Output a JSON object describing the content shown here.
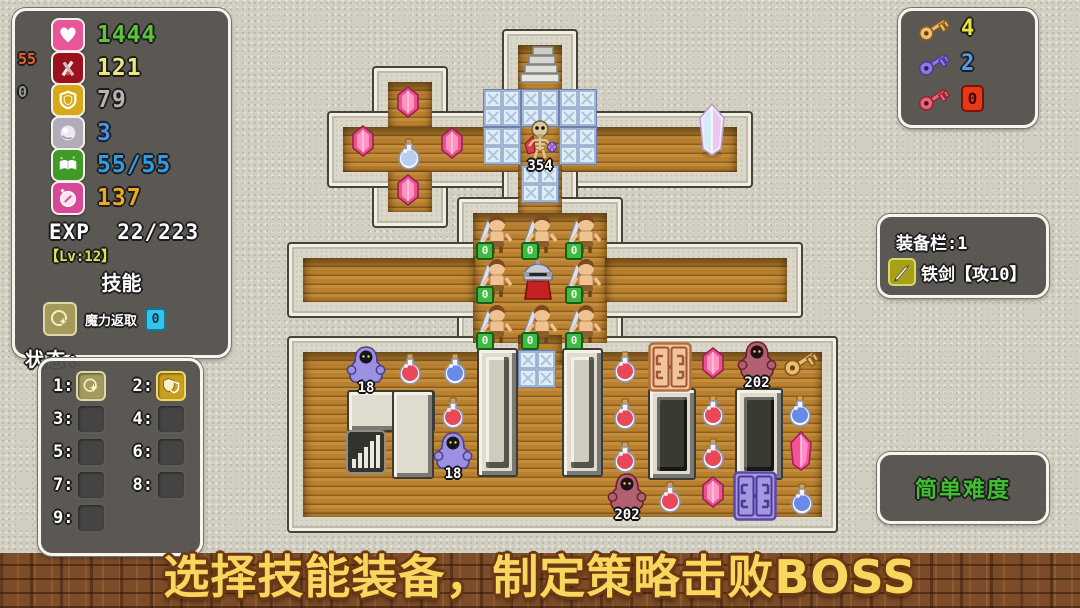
{
  "hud": {
    "stats": {
      "rows": [
        {
          "icon": "heart-icon",
          "value": "1444",
          "color": "#5dc438",
          "icon_bg": "#e8559a"
        },
        {
          "icon": "sword-icon",
          "value": "121",
          "color": "#ece87e",
          "icon_bg": "#9a1220"
        },
        {
          "icon": "shield-icon",
          "value": "79",
          "color": "#b4b4b4",
          "icon_bg": "#d8a818"
        },
        {
          "icon": "orb-icon",
          "value": "3",
          "color": "#4f8fe8",
          "icon_bg": "#b2acba"
        },
        {
          "icon": "book-icon",
          "value": "55/55",
          "color": "#2e9de8",
          "icon_bg": "#3f9a28"
        },
        {
          "icon": "coin-icon",
          "value": "137",
          "color": "#f0a81f",
          "icon_bg": "#d84898"
        }
      ],
      "side_labels": [
        {
          "text": "55",
          "color": "#e8622a",
          "y": 42
        },
        {
          "text": "0",
          "color": "#9a9a9a",
          "y": 76
        }
      ],
      "exp_label": "EXP",
      "exp_value": "22/223",
      "level": "【Lv:12】",
      "skill_header": "技能",
      "skill_name": "魔力返取",
      "skill_count": "0",
      "status_label": "状态:"
    },
    "skill_slots": {
      "slots": [
        {
          "num": "1:",
          "icon": "magic"
        },
        {
          "num": "2:",
          "icon": "guard"
        },
        {
          "num": "3:",
          "icon": ""
        },
        {
          "num": "4:",
          "icon": ""
        },
        {
          "num": "5:",
          "icon": ""
        },
        {
          "num": "6:",
          "icon": ""
        },
        {
          "num": "7:",
          "icon": ""
        },
        {
          "num": "8:",
          "icon": ""
        },
        {
          "num": "9:",
          "icon": ""
        }
      ]
    },
    "keys": [
      {
        "name": "yellow-key",
        "count": "4",
        "count_color": "#ece43e",
        "fill": "#e8c070",
        "stroke": "#8a5a20"
      },
      {
        "name": "blue-key",
        "count": "2",
        "count_color": "#4f9fe8",
        "fill": "#8a7ae0",
        "stroke": "#4a3a9a"
      },
      {
        "name": "red-key",
        "count": "0",
        "count_color": "#3c0800",
        "fill": "#e06a78",
        "stroke": "#9a2030"
      }
    ],
    "equipment": {
      "title": "装备栏:1",
      "item": "铁剑【攻10】"
    },
    "difficulty": {
      "label": "简单难度",
      "color": "#3fc02e"
    }
  },
  "banner": {
    "text": "选择技能装备，制定策略击败BOSS"
  },
  "colors": {
    "floor_wood": "#b9812f",
    "wall_stone": "#dbd8ca",
    "panel_bg": "#53514d",
    "banner_text": "#f8d75e"
  },
  "map": {
    "floors": [
      {
        "name": "cross-room-vertical",
        "x": 388,
        "y": 82,
        "w": 44,
        "h": 130
      },
      {
        "name": "top-corridor",
        "x": 343,
        "y": 127,
        "w": 394,
        "h": 45
      },
      {
        "name": "stairs-column",
        "x": 518,
        "y": 45,
        "w": 44,
        "h": 170
      },
      {
        "name": "soldier-room",
        "x": 473,
        "y": 213,
        "w": 134,
        "h": 130
      },
      {
        "name": "left-corridor",
        "x": 303,
        "y": 258,
        "w": 172,
        "h": 44
      },
      {
        "name": "right-corridor",
        "x": 605,
        "y": 258,
        "w": 182,
        "h": 44
      },
      {
        "name": "bottom-room",
        "x": 303,
        "y": 352,
        "w": 519,
        "h": 165
      },
      {
        "name": "room-connector",
        "x": 518,
        "y": 335,
        "w": 44,
        "h": 30,
        "wall": false
      }
    ],
    "pillars": [
      {
        "x": 347,
        "y": 390,
        "w": 84,
        "h": 38
      },
      {
        "x": 392,
        "y": 390,
        "w": 38,
        "h": 85
      },
      {
        "x": 477,
        "y": 348,
        "w": 37,
        "h": 125,
        "inner": "light"
      },
      {
        "x": 562,
        "y": 348,
        "w": 37,
        "h": 125,
        "inner": "light"
      },
      {
        "x": 648,
        "y": 388,
        "w": 44,
        "h": 88,
        "inner": "dark"
      },
      {
        "x": 735,
        "y": 388,
        "w": 44,
        "h": 88,
        "inner": "dark"
      }
    ],
    "ice_tiles": [
      {
        "x": 483,
        "y": 89
      },
      {
        "x": 521,
        "y": 89
      },
      {
        "x": 559,
        "y": 89
      },
      {
        "x": 483,
        "y": 127
      },
      {
        "x": 559,
        "y": 127
      },
      {
        "x": 521,
        "y": 165
      },
      {
        "x": 518,
        "y": 350
      }
    ],
    "entities": [
      {
        "t": "stairs-up",
        "x": 540,
        "y": 64
      },
      {
        "t": "gem",
        "x": 408,
        "y": 102
      },
      {
        "t": "gem",
        "x": 363,
        "y": 141
      },
      {
        "t": "gem",
        "x": 452,
        "y": 143
      },
      {
        "t": "gem",
        "x": 408,
        "y": 190
      },
      {
        "t": "potion-white",
        "x": 409,
        "y": 155
      },
      {
        "t": "skeleton",
        "x": 540,
        "y": 142,
        "label": "354"
      },
      {
        "t": "crystal-rainbow",
        "x": 712,
        "y": 131
      },
      {
        "t": "soldier",
        "x": 493,
        "y": 235,
        "badge": "0"
      },
      {
        "t": "soldier",
        "x": 538,
        "y": 235,
        "badge": "0"
      },
      {
        "t": "soldier",
        "x": 582,
        "y": 235,
        "badge": "0"
      },
      {
        "t": "soldier",
        "x": 493,
        "y": 279,
        "badge": "0"
      },
      {
        "t": "soldier",
        "x": 582,
        "y": 279,
        "badge": "0"
      },
      {
        "t": "soldier",
        "x": 493,
        "y": 325,
        "badge": "0"
      },
      {
        "t": "soldier",
        "x": 538,
        "y": 325,
        "badge": "0"
      },
      {
        "t": "soldier",
        "x": 582,
        "y": 325,
        "badge": "0"
      },
      {
        "t": "knight",
        "x": 538,
        "y": 279
      },
      {
        "t": "ghost-purple",
        "x": 366,
        "y": 365,
        "label": "18"
      },
      {
        "t": "potion-red",
        "x": 410,
        "y": 370
      },
      {
        "t": "potion-blue",
        "x": 455,
        "y": 370
      },
      {
        "t": "potion-red",
        "x": 453,
        "y": 414
      },
      {
        "t": "ghost-purple",
        "x": 453,
        "y": 451,
        "label": "18"
      },
      {
        "t": "stairs-down",
        "x": 366,
        "y": 452
      },
      {
        "t": "potion-red",
        "x": 625,
        "y": 368
      },
      {
        "t": "door-orange",
        "x": 670,
        "y": 367
      },
      {
        "t": "gem",
        "x": 713,
        "y": 363
      },
      {
        "t": "ghost-red",
        "x": 757,
        "y": 360,
        "label": "202"
      },
      {
        "t": "key-yellow",
        "x": 800,
        "y": 363
      },
      {
        "t": "potion-red",
        "x": 625,
        "y": 415
      },
      {
        "t": "potion-red",
        "x": 713,
        "y": 412
      },
      {
        "t": "potion-blue",
        "x": 800,
        "y": 412
      },
      {
        "t": "potion-red",
        "x": 625,
        "y": 458
      },
      {
        "t": "potion-red",
        "x": 713,
        "y": 455
      },
      {
        "t": "crystal-pink",
        "x": 801,
        "y": 451
      },
      {
        "t": "ghost-red",
        "x": 627,
        "y": 492,
        "label": "202"
      },
      {
        "t": "potion-red",
        "x": 670,
        "y": 498
      },
      {
        "t": "gem",
        "x": 713,
        "y": 492
      },
      {
        "t": "door-purple",
        "x": 755,
        "y": 496
      },
      {
        "t": "potion-blue",
        "x": 802,
        "y": 500
      }
    ]
  }
}
